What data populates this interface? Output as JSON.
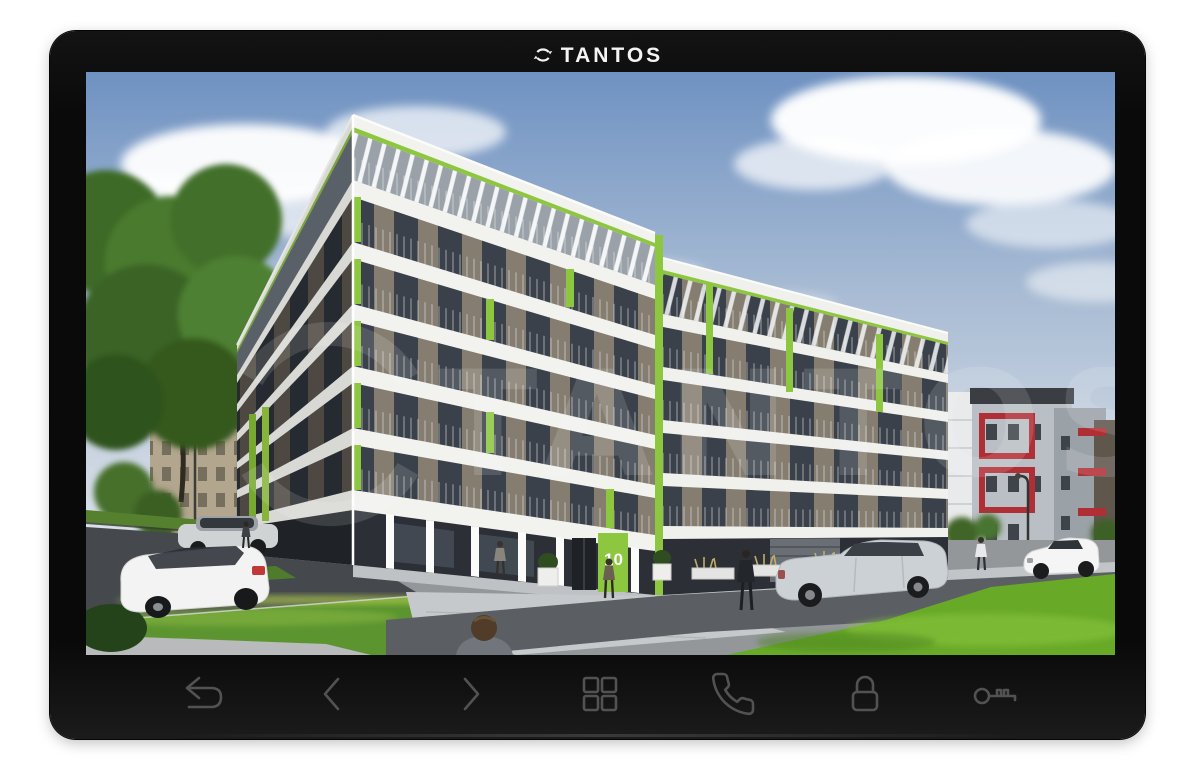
{
  "brand": {
    "logo_text": "TANTOS",
    "logo_icon": "circular-arrows-icon"
  },
  "screen": {
    "watermark_text": "TANTOS",
    "door_number": "10",
    "scene": "apartment-building-camera-view"
  },
  "colors": {
    "bezel_black": "#0a0a0a",
    "icon_gray": "#525252",
    "accent_lime_green": "#8dc63f",
    "red_accent": "#b02f36",
    "sky_blue": "#6f92c2",
    "lawn_green": "#6aae2b",
    "facade_white": "#f2f2ef"
  },
  "buttons": [
    {
      "id": "back",
      "icon": "return-arrow-icon"
    },
    {
      "id": "prev",
      "icon": "chevron-left-icon"
    },
    {
      "id": "next",
      "icon": "chevron-right-icon"
    },
    {
      "id": "menu",
      "icon": "grid-icon"
    },
    {
      "id": "call",
      "icon": "phone-icon"
    },
    {
      "id": "lock",
      "icon": "padlock-icon"
    },
    {
      "id": "unlock",
      "icon": "key-icon"
    }
  ]
}
